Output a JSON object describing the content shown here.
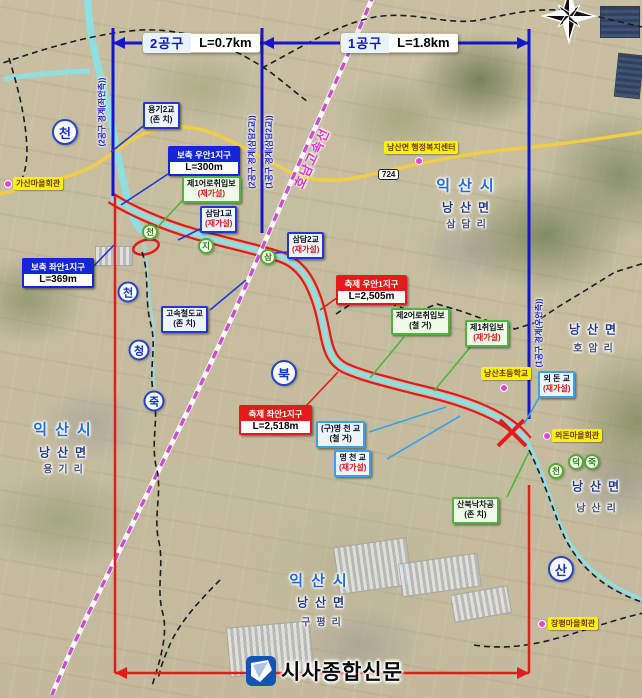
{
  "header": {
    "sections": [
      {
        "label": "2공구",
        "length": "L=0.7km"
      },
      {
        "label": "1공구",
        "length": "L=1.8km"
      }
    ],
    "boundary_labels": [
      "(2공구 경계(좌안측))",
      "(2공구 경계(삼담2교))",
      "(1공구 경계(삼담2교))",
      "(1공구 경계(우안측))"
    ]
  },
  "map": {
    "railway_label": "호남고속선",
    "road_badge": "724"
  },
  "zones": [
    {
      "title": "보축 우안1지구",
      "value": "L=300m"
    },
    {
      "title": "보축 좌안1지구",
      "value": "L=369m"
    },
    {
      "title": "축제 우안1지구",
      "value": "L=2,505m"
    },
    {
      "title": "축제 좌안1지구",
      "value": "L=2,518m"
    }
  ],
  "structures": [
    {
      "name": "용기2교",
      "note": "(존 치)"
    },
    {
      "name": "제1어로취입보",
      "note": "(재가설)"
    },
    {
      "name": "삼담1교",
      "note": "(재가설)"
    },
    {
      "name": "삼담2교",
      "note": "(재가설)"
    },
    {
      "name": "고속철도교",
      "note": "(존 치)"
    },
    {
      "name": "제2어로취입보",
      "note": "(철 거)"
    },
    {
      "name": "제1취입보",
      "note": "(재가설)"
    },
    {
      "name": "외 돈 교",
      "note": "(재가설)"
    },
    {
      "name": "(구)명 천 교",
      "note": "(철 거)"
    },
    {
      "name": "명 천 교",
      "note": "(재가설)"
    },
    {
      "name": "산북낙차공",
      "note": "(존 치)"
    }
  ],
  "pois": [
    {
      "name": "가산마을회관"
    },
    {
      "name": "낭산면 행정복지센터"
    },
    {
      "name": "낭산초등학교"
    },
    {
      "name": "외돈마을회관"
    },
    {
      "name": "장평마을회관"
    }
  ],
  "regions": [
    [
      "익산시",
      "낭산면",
      "삼담리"
    ],
    [
      "낭산면",
      "호암리"
    ],
    [
      "낭산면",
      "낭산리"
    ],
    [
      "익산시",
      "낭산면",
      "용기리"
    ],
    [
      "익산시",
      "낭산면",
      "구평리"
    ]
  ],
  "markers": {
    "blue": [
      "천",
      "천",
      "청",
      "죽",
      "북",
      "산"
    ],
    "green": [
      "천",
      "지",
      "삼",
      "천",
      "덕",
      "죽"
    ]
  },
  "logo": {
    "text": "시사종합신문"
  },
  "icons": {
    "compass": "compass-rose",
    "logo_mark": "newspaper-flag"
  },
  "colors": {
    "section_line": "#1515d0",
    "extent_line": "#e31b1b",
    "river": "#8fdfe2",
    "railway": "#c94fd0",
    "road": "#f0cd45",
    "poi_bg": "#f7f400"
  }
}
